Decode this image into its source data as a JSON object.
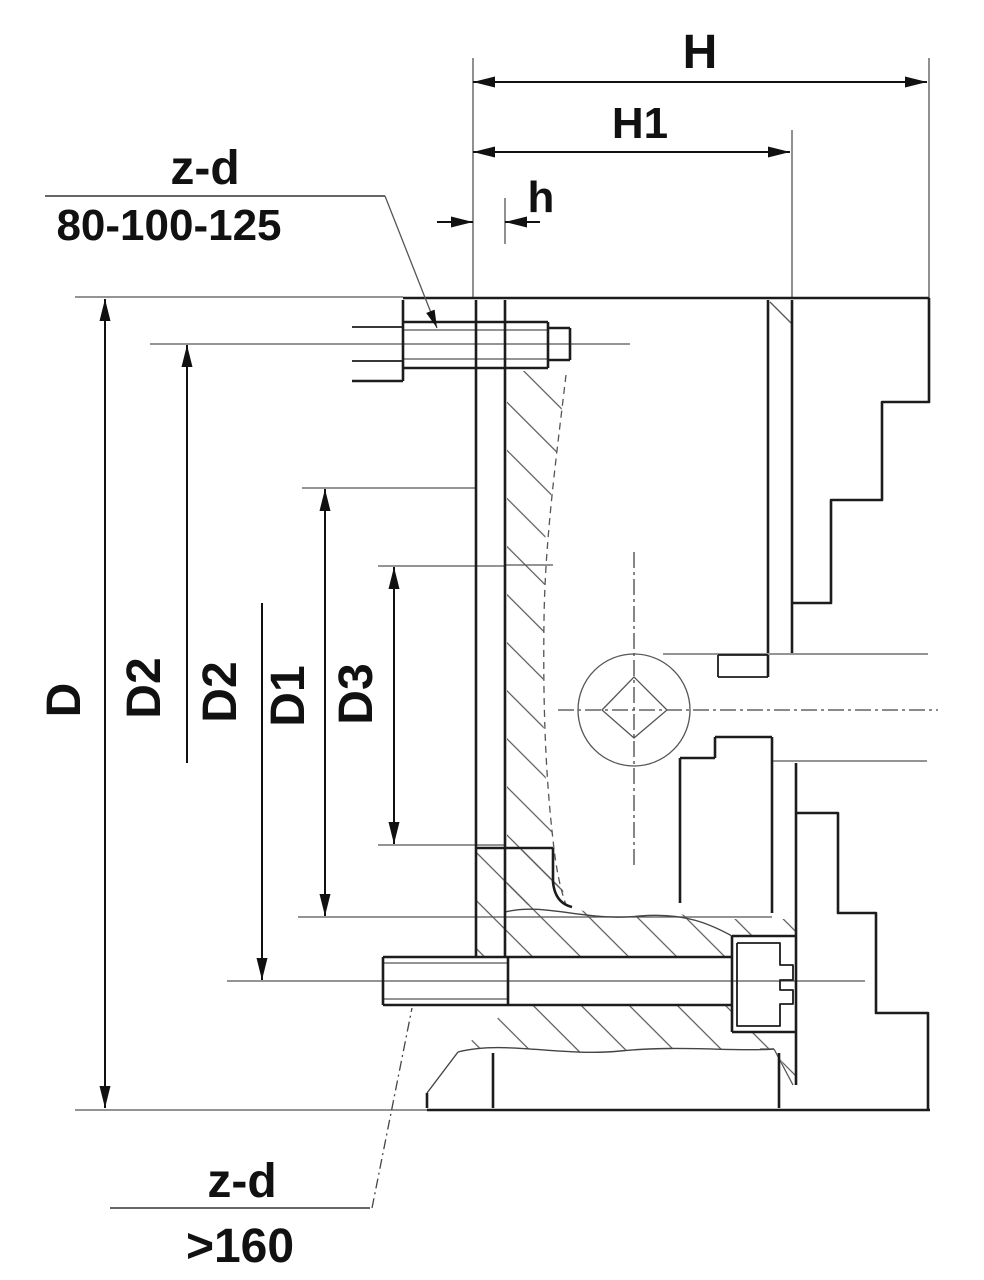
{
  "drawing": {
    "dimensions": {
      "overall_depth": "H",
      "body_depth": "H1",
      "plate_protrusion": "h",
      "outer_diameter": "D",
      "bolt_circle_upper": "D2",
      "bolt_circle_lower": "D2",
      "register_diameter": "D1",
      "pilot_diameter": "D3"
    },
    "callouts": {
      "top": {
        "label": "z-d",
        "range": "80-100-125"
      },
      "bottom": {
        "label": "z-d",
        "range": ">160"
      }
    },
    "colors": {
      "line": "#1c1c1c",
      "thin_line": "#555555",
      "centerline": "#444444",
      "background": "#ffffff"
    }
  }
}
